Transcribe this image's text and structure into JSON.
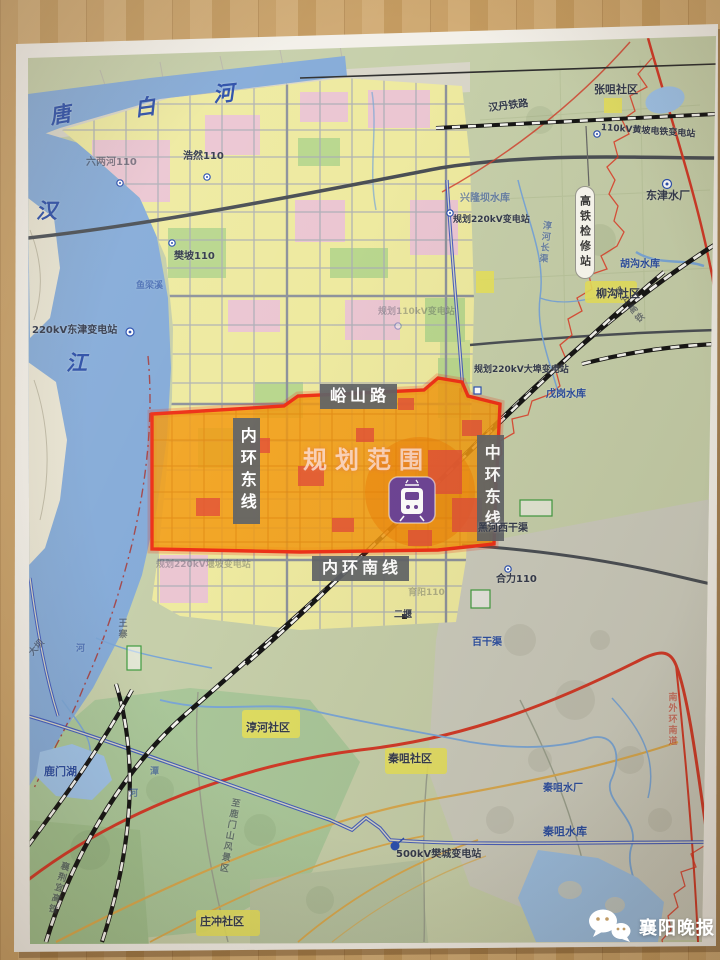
{
  "watermark": {
    "text": "襄阳晚报",
    "icon": "wechat-icon"
  },
  "colors": {
    "wood_desk": "#c9a168",
    "paper": "#f3f0e9",
    "water_blue": "#85abd8",
    "urban_yellow": "#eeeaa0",
    "rural_green": "#c6cfaa",
    "plan_area_fill": "#f29a12",
    "plan_area_border": "#ee3118",
    "road_label_box": "#616468",
    "metro_purple": "#6e4596",
    "red_road": "#d23a28",
    "railway": "#151515",
    "canal_blue": "#3a53bd"
  },
  "map": {
    "plan_area_label": "规划范围",
    "metro_station_icon": "metro-train-icon",
    "labels": [
      {
        "name": "river-tang",
        "text": "唐",
        "x": 48,
        "y": 106,
        "cls": "river",
        "rot": -10
      },
      {
        "name": "river-bai",
        "text": "白",
        "x": 133,
        "y": 98,
        "cls": "river",
        "rot": -8
      },
      {
        "name": "river-he",
        "text": "河",
        "x": 212,
        "y": 84,
        "cls": "river",
        "rot": -6
      },
      {
        "name": "river-han",
        "text": "汉",
        "x": 36,
        "y": 200,
        "cls": "river"
      },
      {
        "name": "river-jiang",
        "text": "江",
        "x": 66,
        "y": 352,
        "cls": "river"
      },
      {
        "name": "sub-liulianghe-110",
        "text": "六两河110",
        "x": 86,
        "y": 158,
        "cls": "dark sm fade"
      },
      {
        "name": "sub-haoran-110",
        "text": "浩然110",
        "x": 183,
        "y": 152,
        "cls": "dark sm"
      },
      {
        "name": "sub-fanpo-110",
        "text": "樊坡110",
        "x": 174,
        "y": 252,
        "cls": "dark sm"
      },
      {
        "name": "stream-yuliangxi",
        "text": "鱼梁溪",
        "x": 136,
        "y": 282,
        "cls": "blue xs fade"
      },
      {
        "name": "sub-dongjin-220kv",
        "text": "220kV东津变电站",
        "x": 32,
        "y": 326,
        "cls": "dark sm"
      },
      {
        "name": "sub-planned-110kv",
        "text": "规划110kV变电站",
        "x": 378,
        "y": 308,
        "cls": "dark xs fade2"
      },
      {
        "name": "rail-handan",
        "text": "汉丹铁路",
        "x": 488,
        "y": 104,
        "cls": "dark sm",
        "rot": -7
      },
      {
        "name": "community-zhangju",
        "text": "张咀社区",
        "x": 594,
        "y": 84,
        "cls": "dark"
      },
      {
        "name": "sub-huangpo-dientie",
        "text": "110kV黄坡电铁变电站",
        "x": 601,
        "y": 124,
        "cls": "dark xs",
        "rot": 4
      },
      {
        "name": "hsr-depot",
        "text": "高铁检修站",
        "x": 575,
        "y": 186,
        "cls": "oval"
      },
      {
        "name": "waterworks-dongjin",
        "text": "东津水厂",
        "x": 646,
        "y": 190,
        "cls": "dark"
      },
      {
        "name": "reservoir-xinglongba",
        "text": "兴隆坝水库",
        "x": 460,
        "y": 194,
        "cls": "blue sm fade"
      },
      {
        "name": "sub-planned-220kv-north",
        "text": "规划220kV变电站",
        "x": 453,
        "y": 216,
        "cls": "dark xs"
      },
      {
        "name": "canal-chunhe-changqu",
        "text": "淳河长渠",
        "x": 541,
        "y": 220,
        "cls": "blue xs v fade",
        "rot": 6
      },
      {
        "name": "reservoir-hugou",
        "text": "胡沟水库",
        "x": 620,
        "y": 260,
        "cls": "blue sm"
      },
      {
        "name": "community-liugou",
        "text": "柳沟社区",
        "x": 596,
        "y": 288,
        "cls": "dark"
      },
      {
        "name": "hsr-zhengwan",
        "text": "郑万高铁",
        "x": 611,
        "y": 292,
        "cls": "dark xs v fade",
        "rot": -38
      },
      {
        "name": "sub-planned-dabu-220kv",
        "text": "规划220kV大埠变电站",
        "x": 474,
        "y": 366,
        "cls": "dark xs"
      },
      {
        "name": "reservoir-wugang",
        "text": "戊岗水库",
        "x": 546,
        "y": 390,
        "cls": "blue sm"
      },
      {
        "name": "roadbox-yushan-road",
        "text": "峪山路",
        "x": 320,
        "y": 384,
        "cls": "boxh"
      },
      {
        "name": "roadbox-neihuan-east",
        "text": "内环东线",
        "x": 233,
        "y": 418,
        "cls": "boxv"
      },
      {
        "name": "roadbox-zhonghuan-east",
        "text": "中环东线",
        "x": 477,
        "y": 435,
        "cls": "boxv"
      },
      {
        "name": "planning-scope-title",
        "text": "规划范围",
        "x": 303,
        "y": 448,
        "cls": "plan"
      },
      {
        "name": "roadbox-neihuan-south",
        "text": "内环南线",
        "x": 312,
        "y": 556,
        "cls": "boxh"
      },
      {
        "name": "canal-heihe-west",
        "text": "黑河西干渠",
        "x": 478,
        "y": 524,
        "cls": "dark sm"
      },
      {
        "name": "sub-heli-110",
        "text": "合力110",
        "x": 496,
        "y": 575,
        "cls": "dark sm"
      },
      {
        "name": "sub-yuyang-110",
        "text": "育阳110",
        "x": 408,
        "y": 589,
        "cls": "dark xs fade2"
      },
      {
        "name": "spot-eryan",
        "text": "二堰",
        "x": 394,
        "y": 611,
        "cls": "dark xs"
      },
      {
        "name": "sub-planned-220kv-south",
        "text": "规划220kV堰坡变电站",
        "x": 156,
        "y": 561,
        "cls": "dark xs fade2"
      },
      {
        "name": "canal-baiganqu",
        "text": "百干渠",
        "x": 472,
        "y": 638,
        "cls": "blue sm"
      },
      {
        "name": "village-wangzhai",
        "text": "王寨",
        "x": 116,
        "y": 618,
        "cls": "dark xs v fade"
      },
      {
        "name": "stream-he-char",
        "text": "河",
        "x": 76,
        "y": 645,
        "cls": "blue xs fade"
      },
      {
        "name": "road-daba",
        "text": "大坝",
        "x": 28,
        "y": 652,
        "cls": "dark xs fade",
        "rot": -48
      },
      {
        "name": "road-nanwaihuan-south",
        "text": "南外环南道",
        "x": 666,
        "y": 692,
        "cls": "red xs v fade"
      },
      {
        "name": "community-chunhe",
        "text": "淳河社区",
        "x": 246,
        "y": 722,
        "cls": "dark"
      },
      {
        "name": "community-qinju",
        "text": "秦咀社区",
        "x": 388,
        "y": 753,
        "cls": "dark"
      },
      {
        "name": "road-to-lumenshan-scenic",
        "text": "至鹿门山风景区",
        "x": 230,
        "y": 797,
        "cls": "dark xs v fade",
        "rot": 10
      },
      {
        "name": "sub-fancheng-500kv",
        "text": "500kV樊城变电站",
        "x": 396,
        "y": 850,
        "cls": "dark sm"
      },
      {
        "name": "lake-lumen",
        "text": "鹿门湖",
        "x": 44,
        "y": 766,
        "cls": "blue"
      },
      {
        "name": "stream-tan-char",
        "text": "潭",
        "x": 150,
        "y": 768,
        "cls": "blue xs fade"
      },
      {
        "name": "stream-tanhe-char",
        "text": "河",
        "x": 129,
        "y": 790,
        "cls": "blue xs fade"
      },
      {
        "name": "hsr-xiangjingyi",
        "text": "襄荆宜高铁",
        "x": 60,
        "y": 860,
        "cls": "dark xs v fade",
        "rot": 16
      },
      {
        "name": "community-zhuangchong",
        "text": "庄冲社区",
        "x": 200,
        "y": 916,
        "cls": "dark"
      },
      {
        "name": "waterworks-qinju",
        "text": "秦咀水厂",
        "x": 543,
        "y": 784,
        "cls": "blue sm"
      },
      {
        "name": "reservoir-qinju",
        "text": "秦咀水库",
        "x": 543,
        "y": 826,
        "cls": "blue"
      }
    ]
  }
}
